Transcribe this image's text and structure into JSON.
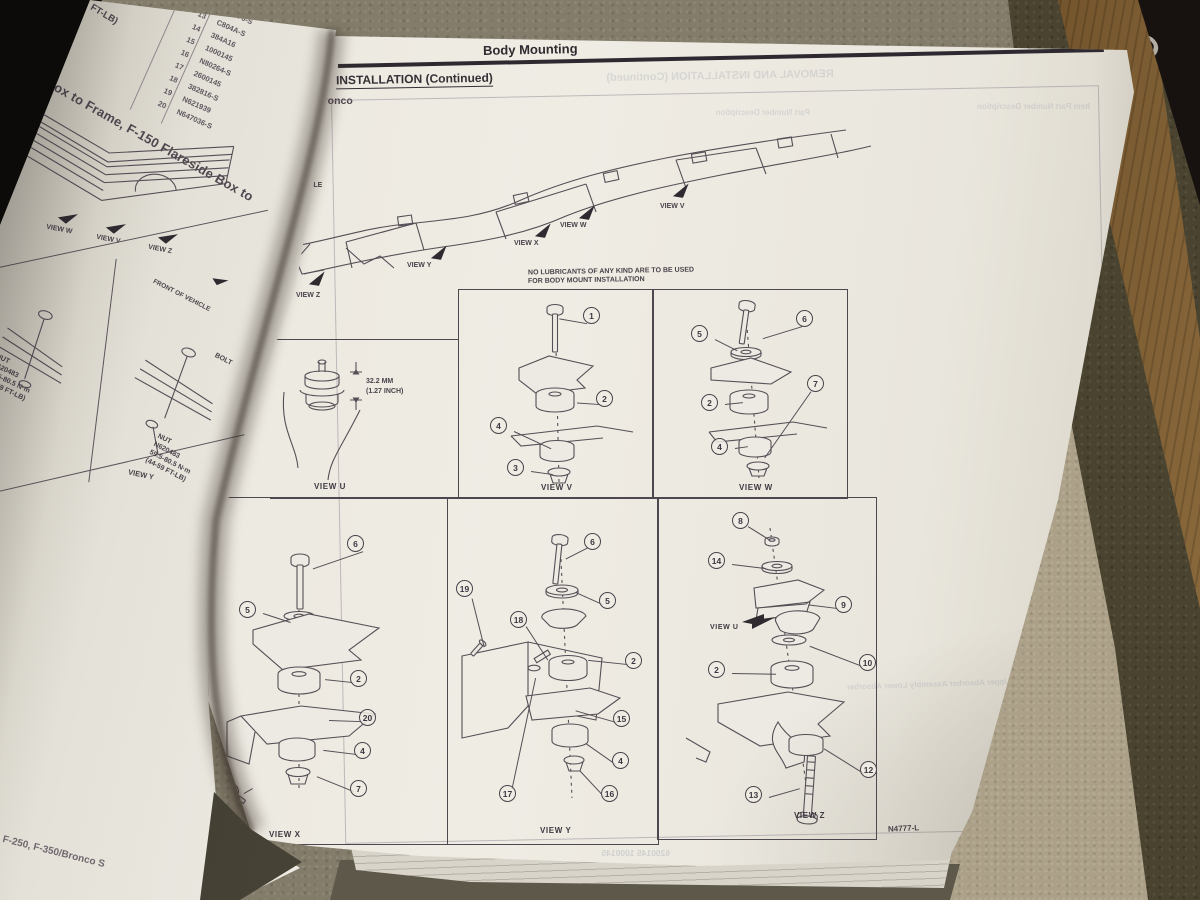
{
  "scene": {
    "spine": {
      "letters": "RGO",
      "year": "1990"
    }
  },
  "left_page": {
    "corner_fragment": "FT-LB)",
    "diagonal_title": "Styleside Box to Frame, F-150 Flareside Box to",
    "table": {
      "items": [
        "12",
        "13",
        "14",
        "15",
        "16",
        "17",
        "18",
        "19",
        "20"
      ],
      "parts": [
        "560376-S",
        "C804A-S",
        "384A16",
        "1000145",
        "N80264-S",
        "2600145",
        "382816-S",
        "N621939",
        "N647036-S"
      ]
    },
    "view_arrows": [
      "VIEW W",
      "VIEW V",
      "VIEW Z"
    ],
    "front_of_vehicle": "FRONT OF VEHICLE",
    "nut_note_left": "NUT\nN620483\n59.5-80.5 N·m\n(44-59 FT-LB)",
    "nut_note_right": "NUT\nN620483\n59.5-80.5 N·m\n(44-59 FT-LB)",
    "bolt_fragment": "BOLT",
    "view_y": "VIEW Y",
    "edge_text": "F-250, F-350/Bronco S"
  },
  "right_page": {
    "header": {
      "title": "Body Mounting",
      "code": "02-02-4"
    },
    "section_heading": "INSTALLATION (Continued)",
    "model": "Bronco",
    "vehicle_fragment": "VEHICLE",
    "lube_note": {
      "line1": "NO LUBRICANTS OF ANY KIND ARE TO BE USED",
      "line2": "FOR BODY MOUNT INSTALLATION"
    },
    "frame_view_labels": {
      "v": "VIEW V",
      "w": "VIEW W",
      "x": "VIEW X",
      "y": "VIEW Y",
      "z": "VIEW Z"
    },
    "dimension": {
      "line1": "32.2 MM",
      "line2": "(1.27 INCH)"
    },
    "panels": {
      "u": {
        "label": "VIEW U"
      },
      "v": {
        "label": "VIEW V",
        "callouts": [
          "1",
          "2",
          "4",
          "3"
        ]
      },
      "w": {
        "label": "VIEW W",
        "callouts": [
          "6",
          "5",
          "2",
          "4",
          "7"
        ]
      },
      "x": {
        "label": "VIEW X",
        "callouts": [
          "6",
          "5",
          "2",
          "20",
          "4",
          "7",
          "21"
        ]
      },
      "y": {
        "label": "VIEW Y",
        "callouts": [
          "6",
          "5",
          "19",
          "18",
          "2",
          "15",
          "4",
          "17",
          "16"
        ]
      },
      "z": {
        "label": "VIEW Z",
        "inner_view_label": "VIEW U",
        "callouts": [
          "8",
          "14",
          "9",
          "10",
          "2",
          "12",
          "13"
        ]
      }
    },
    "figure_code": "N4777-L",
    "ghost": {
      "removal": "REMOVAL AND INSTALLATION (Continued)",
      "table_header_1": "Part Number     Description",
      "table_header_2": "Item    Part Number     Description",
      "numbers": "6200145     1000145",
      "absorber": "Upper Absorber Assembly\nLower Absorber"
    }
  },
  "colors": {
    "paper": "#eceae1",
    "ink": "#4a424a",
    "black": "#2b252c",
    "carpet": "#847d6b",
    "carpet_light": "#aca188",
    "surface_dark": "#49432f",
    "wood": "#7b5a31",
    "spine": "#171210"
  }
}
